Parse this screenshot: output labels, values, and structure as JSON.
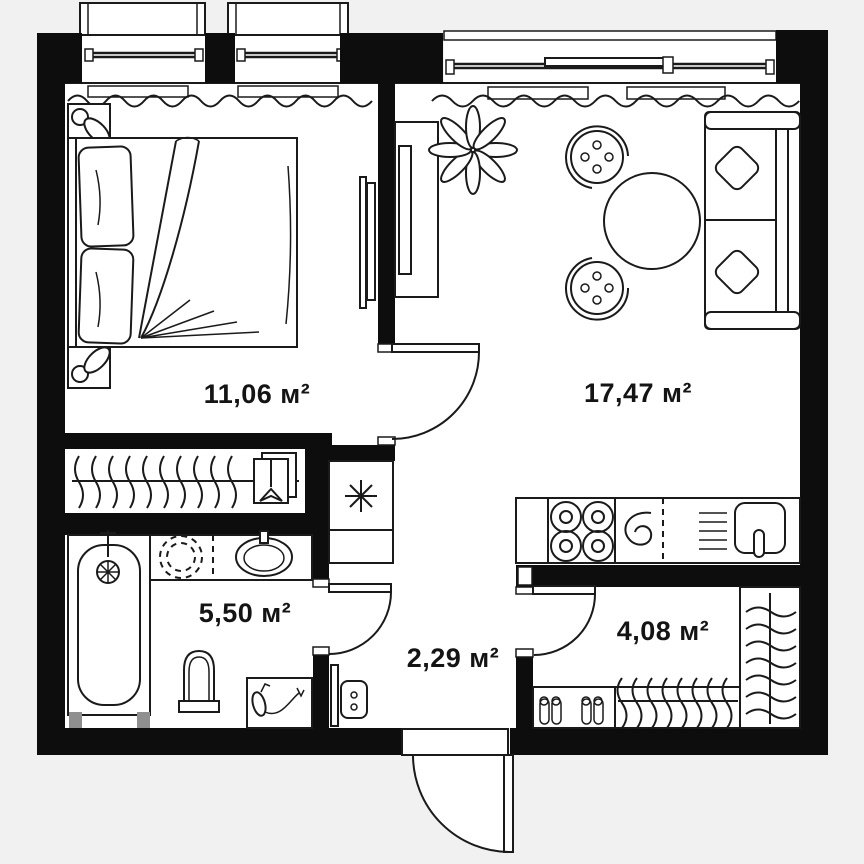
{
  "plan": {
    "type": "apartment-floor-plan",
    "unit": "м²",
    "colors": {
      "wall": "#0d0d0d",
      "line": "#1a1a1a",
      "paper": "#ffffff",
      "exterior": "#f1f1f2",
      "label": "#141414",
      "tub_feet": "#8f8f8f"
    },
    "rooms": [
      {
        "id": "bedroom",
        "label": "11,06 м²",
        "fixtures": [
          "double-bed",
          "nightstand-lamp",
          "nightstand-lamp",
          "tv",
          "window-balcony",
          "window-balcony",
          "curtain"
        ]
      },
      {
        "id": "living-kitchen",
        "label": "17,47 м²",
        "fixtures": [
          "sofa",
          "sofa-pillow",
          "sofa-pillow",
          "round-table",
          "chair",
          "chair",
          "plant",
          "tv-console",
          "panoramic-window",
          "kitchen-counter",
          "hob",
          "spiral-drain",
          "dish-rack",
          "kitchen-sink"
        ]
      },
      {
        "id": "bathroom",
        "label": "5,50 м²",
        "fixtures": [
          "bathtub",
          "washing-machine",
          "vanity-sink",
          "toilet",
          "hairdryer-table"
        ]
      },
      {
        "id": "hallway",
        "label": "2,29 м²",
        "fixtures": [
          "utility-closet",
          "utility-asterisk",
          "electrical-panel",
          "mirror",
          "entrance-door"
        ]
      },
      {
        "id": "entry-hall",
        "label": "4,08 м²",
        "fixtures": [
          "wardrobe-hangers",
          "hanger-rail",
          "shoe-shelf"
        ]
      }
    ]
  }
}
